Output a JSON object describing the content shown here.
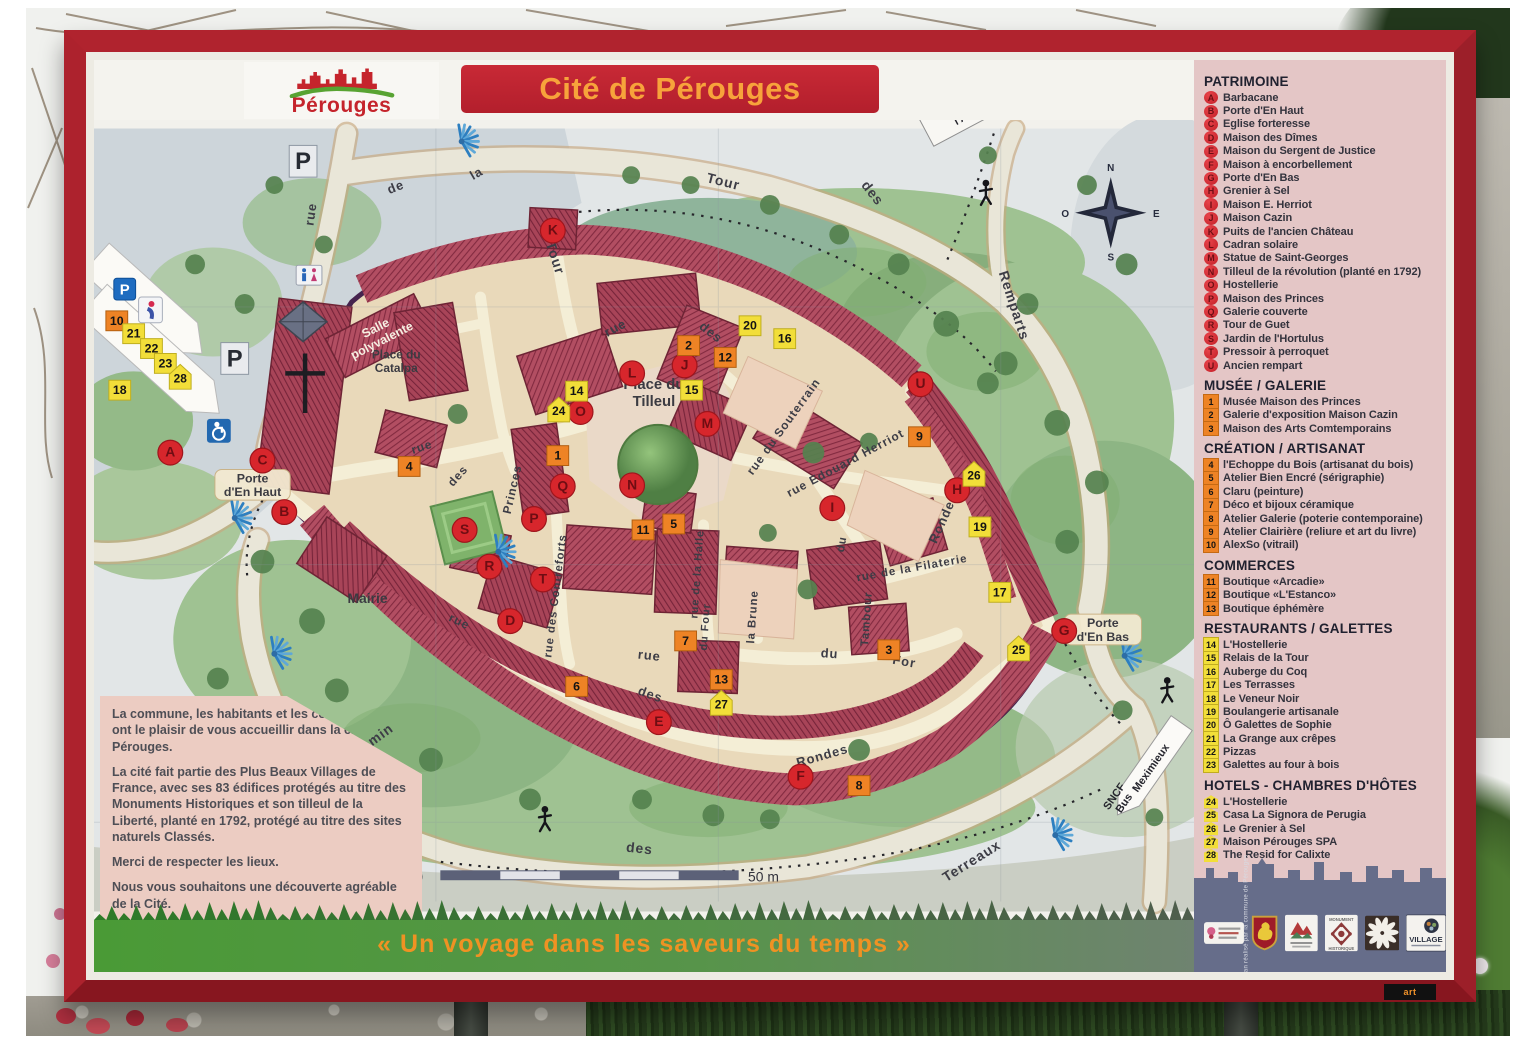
{
  "sign": {
    "logo": {
      "name": "Pérouges",
      "color": "#c5242c"
    },
    "title": "Cité de Pérouges",
    "tagline": "« Un voyage dans les saveurs du temps »",
    "credits": "Illustration · Plan réalisé par la commune de Pérouges",
    "artprint": "art",
    "scale": {
      "start": "0",
      "end": "50 m"
    },
    "welcome": {
      "paragraphs": [
        "La commune, les habitants et les commerçants ont le plaisir de vous accueillir dans la cité de Pérouges.",
        "La cité fait partie des Plus Beaux Villages de France, avec ses 83 édifices protégés au titre des Monuments Historiques et son tilleul de la Liberté, planté en 1792, protégé au titre des sites naturels Classés.",
        "Merci de respecter les lieux.",
        "Nous vous souhaitons une découverte agréable de la Cité."
      ]
    }
  },
  "legend": {
    "sections": [
      {
        "title": "PATRIMOINE",
        "badge": "letter",
        "items": [
          {
            "k": "A",
            "label": "Barbacane"
          },
          {
            "k": "B",
            "label": "Porte d'En Haut"
          },
          {
            "k": "C",
            "label": "Eglise forteresse"
          },
          {
            "k": "D",
            "label": "Maison des Dîmes"
          },
          {
            "k": "E",
            "label": "Maison du Sergent de Justice"
          },
          {
            "k": "F",
            "label": "Maison à encorbellement"
          },
          {
            "k": "G",
            "label": "Porte d'En Bas"
          },
          {
            "k": "H",
            "label": "Grenier à Sel"
          },
          {
            "k": "I",
            "label": "Maison E. Herriot"
          },
          {
            "k": "J",
            "label": "Maison Cazin"
          },
          {
            "k": "K",
            "label": "Puits de l'ancien Château"
          },
          {
            "k": "L",
            "label": "Cadran solaire"
          },
          {
            "k": "M",
            "label": "Statue de Saint-Georges"
          },
          {
            "k": "N",
            "label": "Tilleul de la révolution (planté en 1792)"
          },
          {
            "k": "O",
            "label": "Hostellerie"
          },
          {
            "k": "P",
            "label": "Maison des Princes"
          },
          {
            "k": "Q",
            "label": "Galerie couverte"
          },
          {
            "k": "R",
            "label": "Tour de Guet"
          },
          {
            "k": "S",
            "label": "Jardin de l'Hortulus"
          },
          {
            "k": "T",
            "label": "Pressoir à perroquet"
          },
          {
            "k": "U",
            "label": "Ancien rempart"
          }
        ]
      },
      {
        "title": "MUSÉE / GALERIE",
        "badge": "orange",
        "items": [
          {
            "k": "1",
            "label": "Musée Maison des Princes"
          },
          {
            "k": "2",
            "label": "Galerie d'exposition Maison Cazin"
          },
          {
            "k": "3",
            "label": "Maison des Arts Comtemporains"
          }
        ]
      },
      {
        "title": "CRÉATION / ARTISANAT",
        "badge": "orange",
        "items": [
          {
            "k": "4",
            "label": "l'Echoppe du Bois (artisanat du bois)"
          },
          {
            "k": "5",
            "label": "Atelier Bien Encré (sérigraphie)"
          },
          {
            "k": "6",
            "label": "Claru (peinture)"
          },
          {
            "k": "7",
            "label": "Déco et bijoux céramique"
          },
          {
            "k": "8",
            "label": "Atelier Galerie (poterie contemporaine)"
          },
          {
            "k": "9",
            "label": "Atelier Clairière (reliure et art du livre)"
          },
          {
            "k": "10",
            "label": "AlexSo (vitrail)"
          }
        ]
      },
      {
        "title": "COMMERCES",
        "badge": "orange",
        "items": [
          {
            "k": "11",
            "label": "Boutique «Arcadie»"
          },
          {
            "k": "12",
            "label": "Boutique «L'Estanco»"
          },
          {
            "k": "13",
            "label": "Boutique éphémère"
          }
        ]
      },
      {
        "title": "RESTAURANTS / GALETTES",
        "badge": "yellow",
        "items": [
          {
            "k": "14",
            "label": "L'Hostellerie"
          },
          {
            "k": "15",
            "label": "Relais de la Tour"
          },
          {
            "k": "16",
            "label": "Auberge du Coq"
          },
          {
            "k": "17",
            "label": "Les Terrasses"
          },
          {
            "k": "18",
            "label": "Le Veneur Noir"
          },
          {
            "k": "19",
            "label": "Boulangerie artisanale"
          },
          {
            "k": "20",
            "label": "Ô Galettes de Sophie"
          },
          {
            "k": "21",
            "label": "La Grange aux crêpes"
          },
          {
            "k": "22",
            "label": "Pizzas"
          },
          {
            "k": "23",
            "label": "Galettes au four à bois"
          }
        ]
      },
      {
        "title": "HOTELS - CHAMBRES D'HÔTES",
        "badge": "house",
        "items": [
          {
            "k": "24",
            "label": "L'Hostellerie"
          },
          {
            "k": "25",
            "label": "Casa La Signora de Perugia"
          },
          {
            "k": "26",
            "label": "Le Grenier à Sel"
          },
          {
            "k": "27",
            "label": "Maison Pérouges SPA"
          },
          {
            "k": "28",
            "label": "The Resid for Calixte"
          }
        ]
      }
    ]
  },
  "map": {
    "compass": {
      "n": "N",
      "s": "S",
      "e": "E",
      "o": "O"
    },
    "markers": [
      {
        "k": "A",
        "t": "L",
        "x": 157,
        "y": 452
      },
      {
        "k": "B",
        "t": "L",
        "x": 272,
        "y": 512
      },
      {
        "k": "C",
        "t": "L",
        "x": 250,
        "y": 460
      },
      {
        "k": "D",
        "t": "L",
        "x": 500,
        "y": 622
      },
      {
        "k": "E",
        "t": "L",
        "x": 650,
        "y": 724
      },
      {
        "k": "F",
        "t": "L",
        "x": 793,
        "y": 779
      },
      {
        "k": "G",
        "t": "L",
        "x": 1059,
        "y": 632
      },
      {
        "k": "H",
        "t": "L",
        "x": 951,
        "y": 490
      },
      {
        "k": "I",
        "t": "L",
        "x": 825,
        "y": 508
      },
      {
        "k": "J",
        "t": "L",
        "x": 676,
        "y": 364
      },
      {
        "k": "K",
        "t": "L",
        "x": 543,
        "y": 228
      },
      {
        "k": "L",
        "t": "L",
        "x": 623,
        "y": 372
      },
      {
        "k": "M",
        "t": "L",
        "x": 699,
        "y": 423
      },
      {
        "k": "N",
        "t": "L",
        "x": 623,
        "y": 485
      },
      {
        "k": "O",
        "t": "L",
        "x": 571,
        "y": 411
      },
      {
        "k": "P",
        "t": "L",
        "x": 524,
        "y": 519
      },
      {
        "k": "Q",
        "t": "L",
        "x": 553,
        "y": 486
      },
      {
        "k": "R",
        "t": "L",
        "x": 479,
        "y": 567
      },
      {
        "k": "S",
        "t": "L",
        "x": 454,
        "y": 530
      },
      {
        "k": "T",
        "t": "L",
        "x": 533,
        "y": 580
      },
      {
        "k": "U",
        "t": "L",
        "x": 914,
        "y": 383
      },
      {
        "k": "1",
        "t": "O",
        "x": 548,
        "y": 455
      },
      {
        "k": "2",
        "t": "O",
        "x": 680,
        "y": 344
      },
      {
        "k": "3",
        "t": "O",
        "x": 882,
        "y": 651
      },
      {
        "k": "4",
        "t": "O",
        "x": 398,
        "y": 466
      },
      {
        "k": "5",
        "t": "O",
        "x": 665,
        "y": 524
      },
      {
        "k": "6",
        "t": "O",
        "x": 567,
        "y": 688
      },
      {
        "k": "7",
        "t": "O",
        "x": 677,
        "y": 642
      },
      {
        "k": "8",
        "t": "O",
        "x": 852,
        "y": 788
      },
      {
        "k": "9",
        "t": "O",
        "x": 913,
        "y": 436
      },
      {
        "k": "10",
        "t": "O",
        "x": 103,
        "y": 319
      },
      {
        "k": "11",
        "t": "O",
        "x": 634,
        "y": 530
      },
      {
        "k": "12",
        "t": "O",
        "x": 717,
        "y": 356
      },
      {
        "k": "13",
        "t": "O",
        "x": 713,
        "y": 681
      },
      {
        "k": "14",
        "t": "Y",
        "x": 567,
        "y": 390
      },
      {
        "k": "15",
        "t": "Y",
        "x": 683,
        "y": 389
      },
      {
        "k": "16",
        "t": "Y",
        "x": 777,
        "y": 337
      },
      {
        "k": "17",
        "t": "Y",
        "x": 994,
        "y": 593
      },
      {
        "k": "18",
        "t": "Y",
        "x": 106,
        "y": 389
      },
      {
        "k": "19",
        "t": "Y",
        "x": 974,
        "y": 527
      },
      {
        "k": "20",
        "t": "Y",
        "x": 742,
        "y": 324
      },
      {
        "k": "21",
        "t": "Y",
        "x": 120,
        "y": 332
      },
      {
        "k": "22",
        "t": "Y",
        "x": 138,
        "y": 347
      },
      {
        "k": "23",
        "t": "Y",
        "x": 152,
        "y": 362
      },
      {
        "k": "24",
        "t": "H",
        "x": 549,
        "y": 410
      },
      {
        "k": "25",
        "t": "H",
        "x": 1013,
        "y": 651
      },
      {
        "k": "26",
        "t": "H",
        "x": 968,
        "y": 475
      },
      {
        "k": "27",
        "t": "H",
        "x": 713,
        "y": 706
      },
      {
        "k": "28",
        "t": "H",
        "x": 167,
        "y": 377
      }
    ],
    "street_labels": [
      [
        "rue",
        303,
        212,
        -82,
        13
      ],
      [
        "de",
        386,
        188,
        -22,
        13
      ],
      [
        "la",
        468,
        174,
        -30,
        13
      ],
      [
        "Tour",
        541,
        257,
        72,
        14
      ],
      [
        "Tour",
        714,
        183,
        14,
        14
      ],
      [
        "des",
        862,
        193,
        52,
        14
      ],
      [
        "Remparts",
        1004,
        305,
        72,
        14
      ],
      [
        "rue",
        608,
        330,
        -28,
        13
      ],
      [
        "des",
        700,
        334,
        38,
        13
      ],
      [
        "rue",
        412,
        450,
        -18,
        12
      ],
      [
        "des",
        450,
        478,
        -48,
        12
      ],
      [
        "Princes",
        506,
        490,
        -77,
        12
      ],
      [
        "rue des Contreforts",
        549,
        597,
        -83,
        11.5
      ],
      [
        "rue",
        640,
        661,
        6,
        13
      ],
      [
        "du",
        822,
        659,
        4,
        13
      ],
      [
        "For",
        897,
        667,
        10,
        13
      ],
      [
        "rue de la Halle",
        692,
        575,
        -86,
        11
      ],
      [
        "du Four",
        700,
        628,
        -86,
        11
      ],
      [
        "la Brune",
        748,
        618,
        -86,
        11.5
      ],
      [
        "Tambour",
        863,
        620,
        -86,
        11.5
      ],
      [
        "du",
        838,
        545,
        -80,
        11.5
      ],
      [
        "rue du Souterrain",
        779,
        428,
        -54,
        12
      ],
      [
        "rue Edouard Herriot",
        840,
        466,
        -28,
        12
      ],
      [
        "rue de la Filaterie",
        906,
        572,
        -10,
        11.5
      ],
      [
        "Rondes",
        941,
        520,
        -66,
        13
      ],
      [
        "Rondes",
        816,
        762,
        -16,
        13
      ],
      [
        "des",
        640,
        700,
        20,
        13
      ],
      [
        "rue",
        447,
        626,
        26,
        12
      ],
      [
        "Chemin",
        360,
        749,
        -36,
        14
      ],
      [
        "des",
        630,
        856,
        6,
        14
      ],
      [
        "Terreaux",
        968,
        868,
        -32,
        14
      ]
    ],
    "place_labels": [
      {
        "lines": [
          "Place du",
          "Tilleul"
        ],
        "x": 645,
        "y": 388,
        "s": 15
      },
      {
        "lines": [
          "Place du",
          "Catalpa"
        ],
        "x": 385,
        "y": 357,
        "s": 12
      },
      {
        "lines": [
          "Porte",
          "d'En Haut"
        ],
        "x": 240,
        "y": 482,
        "s": 12.5,
        "pill": true,
        "pw": 76,
        "ph": 31
      },
      {
        "lines": [
          "Porte",
          "d'En Bas"
        ],
        "x": 1098,
        "y": 628,
        "s": 12.5,
        "pill": true,
        "pw": 78,
        "ph": 31
      },
      {
        "lines": [
          "Mairie"
        ],
        "x": 356,
        "y": 604,
        "s": 14
      },
      {
        "lines": [
          "Salle",
          "polyvalente"
        ],
        "x": 366,
        "y": 330,
        "s": 12.5,
        "r": -27,
        "color": "#f6efe2"
      }
    ],
    "signs": [
      {
        "id": "etang",
        "lines": [
          "Étang de",
          "l'Aubépin"
        ],
        "y0": -3,
        "lh": 12
      },
      {
        "id": "mexi",
        "lines": [
          "Meximieux"
        ],
        "y0": 4,
        "lh": 0
      },
      {
        "id": "sncf",
        "lines": [
          "SNCF",
          "Bus"
        ],
        "y0": -2,
        "lh": 12
      }
    ],
    "icons": [
      {
        "type": "parking-big",
        "x": 291,
        "y": 158
      },
      {
        "type": "parking-big",
        "x": 222,
        "y": 357
      },
      {
        "type": "parking-blue",
        "x": 111,
        "y": 287
      },
      {
        "type": "info",
        "x": 137,
        "y": 308
      },
      {
        "type": "handicap",
        "x": 206,
        "y": 430
      },
      {
        "type": "wc",
        "x": 297,
        "y": 273
      },
      {
        "type": "walker",
        "x": 980,
        "y": 190
      },
      {
        "type": "walker",
        "x": 1163,
        "y": 692
      },
      {
        "type": "walker",
        "x": 535,
        "y": 822
      },
      {
        "type": "fan",
        "x": 451,
        "y": 138
      },
      {
        "type": "fan",
        "x": 222,
        "y": 518
      },
      {
        "type": "fan",
        "x": 488,
        "y": 552
      },
      {
        "type": "fan",
        "x": 262,
        "y": 655
      },
      {
        "type": "fan",
        "x": 1120,
        "y": 657
      },
      {
        "type": "fan",
        "x": 1050,
        "y": 838
      }
    ]
  },
  "footer_logos": [
    {
      "name": "fleur-label"
    },
    {
      "name": "blason-perouges"
    },
    {
      "name": "plus-beaux-villages"
    },
    {
      "name": "monument-historique",
      "label_top": "MONUMENT",
      "label_bottom": "HISTORIQUE"
    },
    {
      "name": "rosace"
    },
    {
      "name": "village",
      "label": "VILLAGE"
    }
  ]
}
